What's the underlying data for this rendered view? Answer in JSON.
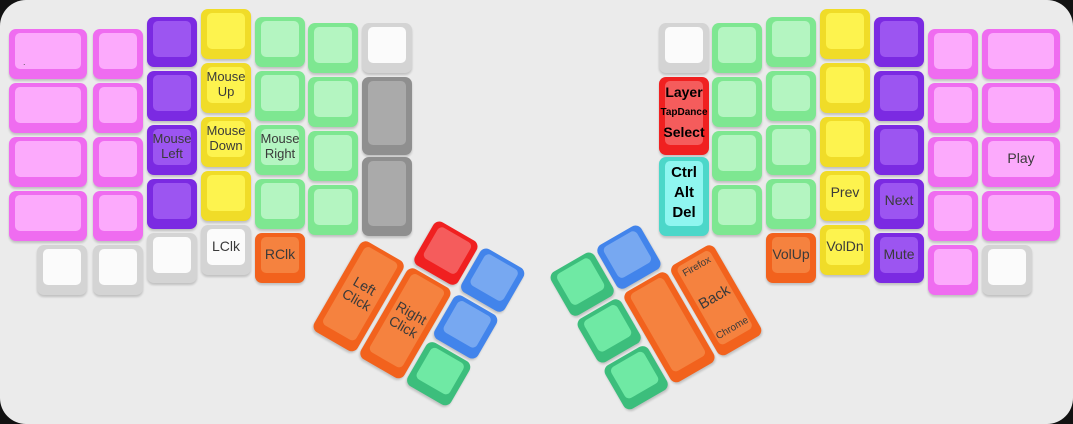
{
  "page": {
    "canvas_background": "#ebebeb",
    "outside_background": "#121212"
  },
  "palette": {
    "pink": {
      "border": "#ef6cf0",
      "face": "#fcaafc"
    },
    "purple": {
      "border": "#7b2ae2",
      "face": "#9c55f1"
    },
    "yellow": {
      "border": "#f0dc28",
      "face": "#fdf34e"
    },
    "palegreen": {
      "border": "#7ee791",
      "face": "#b4f5c1"
    },
    "white": {
      "border": "#d4d4d4",
      "face": "#fbfbfb"
    },
    "gray": {
      "border": "#8f8f8f",
      "face": "#aaaaaa"
    },
    "orange": {
      "border": "#f2621d",
      "face": "#f5823f"
    },
    "red": {
      "border": "#f02020",
      "face": "#f55c5c"
    },
    "cyan": {
      "border": "#4cd7c9",
      "face": "#8ff6f0"
    },
    "blue": {
      "border": "#4284eb",
      "face": "#77a8f1"
    },
    "emerald": {
      "border": "#3cbe7c",
      "face": "#6fe9a4"
    }
  },
  "keyboard": {
    "unit_px": 54,
    "key_px": 50,
    "main_keys": [
      {
        "name": "key-left-col1-row1",
        "color": "pink",
        "x": 9,
        "y": 29,
        "w": 78,
        "h": 50,
        "labels": [
          {
            "t": ".",
            "cls": "dot"
          }
        ]
      },
      {
        "name": "key-left-col1-row2",
        "color": "pink",
        "x": 9,
        "y": 83,
        "w": 78,
        "h": 50,
        "labels": []
      },
      {
        "name": "key-left-col1-row3",
        "color": "pink",
        "x": 9,
        "y": 137,
        "w": 78,
        "h": 50,
        "labels": []
      },
      {
        "name": "key-left-col1-row4",
        "color": "pink",
        "x": 9,
        "y": 191,
        "w": 78,
        "h": 50,
        "labels": []
      },
      {
        "name": "key-left-col1-row5",
        "color": "white",
        "x": 37,
        "y": 245,
        "w": 50,
        "h": 50,
        "labels": []
      },
      {
        "name": "key-left-col2-row1",
        "color": "pink",
        "x": 93,
        "y": 29,
        "w": 50,
        "h": 50,
        "labels": []
      },
      {
        "name": "key-left-col2-row2",
        "color": "pink",
        "x": 93,
        "y": 83,
        "w": 50,
        "h": 50,
        "labels": []
      },
      {
        "name": "key-left-col2-row3",
        "color": "pink",
        "x": 93,
        "y": 137,
        "w": 50,
        "h": 50,
        "labels": []
      },
      {
        "name": "key-left-col2-row4",
        "color": "pink",
        "x": 93,
        "y": 191,
        "w": 50,
        "h": 50,
        "labels": []
      },
      {
        "name": "key-left-col2-row5",
        "color": "white",
        "x": 93,
        "y": 245,
        "w": 50,
        "h": 50,
        "labels": []
      },
      {
        "name": "key-left-col3-row1",
        "color": "purple",
        "x": 147,
        "y": 17,
        "w": 50,
        "h": 50,
        "labels": []
      },
      {
        "name": "key-left-col3-row2",
        "color": "purple",
        "x": 147,
        "y": 71,
        "w": 50,
        "h": 50,
        "labels": []
      },
      {
        "name": "key-mouse-left",
        "color": "purple",
        "x": 147,
        "y": 125,
        "w": 50,
        "h": 50,
        "labels": [
          {
            "t": "Mouse\nLeft",
            "cls": ""
          }
        ]
      },
      {
        "name": "key-left-col3-row4",
        "color": "purple",
        "x": 147,
        "y": 179,
        "w": 50,
        "h": 50,
        "labels": []
      },
      {
        "name": "key-left-col3-row5",
        "color": "white",
        "x": 147,
        "y": 233,
        "w": 50,
        "h": 50,
        "labels": []
      },
      {
        "name": "key-left-col4-row1",
        "color": "yellow",
        "x": 201,
        "y": 9,
        "w": 50,
        "h": 50,
        "labels": []
      },
      {
        "name": "key-mouse-up",
        "color": "yellow",
        "x": 201,
        "y": 63,
        "w": 50,
        "h": 50,
        "labels": [
          {
            "t": "Mouse\nUp",
            "cls": ""
          }
        ]
      },
      {
        "name": "key-mouse-down",
        "color": "yellow",
        "x": 201,
        "y": 117,
        "w": 50,
        "h": 50,
        "labels": [
          {
            "t": "Mouse\nDown",
            "cls": ""
          }
        ]
      },
      {
        "name": "key-left-col4-row4",
        "color": "yellow",
        "x": 201,
        "y": 171,
        "w": 50,
        "h": 50,
        "labels": []
      },
      {
        "name": "key-lclk",
        "color": "white",
        "x": 201,
        "y": 225,
        "w": 50,
        "h": 50,
        "labels": [
          {
            "t": "LClk",
            "cls": "md"
          }
        ]
      },
      {
        "name": "key-left-col5-row1",
        "color": "palegreen",
        "x": 255,
        "y": 17,
        "w": 50,
        "h": 50,
        "labels": []
      },
      {
        "name": "key-left-col5-row2",
        "color": "palegreen",
        "x": 255,
        "y": 71,
        "w": 50,
        "h": 50,
        "labels": []
      },
      {
        "name": "key-mouse-right",
        "color": "palegreen",
        "x": 255,
        "y": 125,
        "w": 50,
        "h": 50,
        "labels": [
          {
            "t": "Mouse\nRight",
            "cls": ""
          }
        ]
      },
      {
        "name": "key-left-col5-row4",
        "color": "palegreen",
        "x": 255,
        "y": 179,
        "w": 50,
        "h": 50,
        "labels": []
      },
      {
        "name": "key-rclk",
        "color": "orange",
        "x": 255,
        "y": 233,
        "w": 50,
        "h": 50,
        "labels": [
          {
            "t": "RClk",
            "cls": "md"
          }
        ]
      },
      {
        "name": "key-left-col6-row1",
        "color": "palegreen",
        "x": 308,
        "y": 23,
        "w": 50,
        "h": 50,
        "labels": []
      },
      {
        "name": "key-left-col6-row2",
        "color": "palegreen",
        "x": 308,
        "y": 77,
        "w": 50,
        "h": 50,
        "labels": []
      },
      {
        "name": "key-left-col6-row3",
        "color": "palegreen",
        "x": 308,
        "y": 131,
        "w": 50,
        "h": 50,
        "labels": []
      },
      {
        "name": "key-left-col6-row4",
        "color": "palegreen",
        "x": 308,
        "y": 185,
        "w": 50,
        "h": 50,
        "labels": []
      },
      {
        "name": "key-left-col7-row1",
        "color": "white",
        "x": 362,
        "y": 23,
        "w": 50,
        "h": 50,
        "labels": []
      },
      {
        "name": "key-left-col7-tall1",
        "color": "gray",
        "x": 362,
        "y": 77,
        "w": 50,
        "h": 78,
        "labels": []
      },
      {
        "name": "key-left-col7-tall2",
        "color": "gray",
        "x": 362,
        "y": 157,
        "w": 50,
        "h": 79,
        "labels": []
      },
      {
        "name": "key-right-col7-row1",
        "color": "white",
        "x": 659,
        "y": 23,
        "w": 50,
        "h": 50,
        "labels": []
      },
      {
        "name": "key-layer-tapdance-select",
        "color": "red",
        "x": 659,
        "y": 77,
        "w": 50,
        "h": 78,
        "labels": [
          {
            "t": "Layer",
            "cls": "bold md"
          },
          {
            "t": "TapDance",
            "cls": "bold xs"
          },
          {
            "t": "Select",
            "cls": "bold md"
          }
        ]
      },
      {
        "name": "key-ctrl-alt-del",
        "color": "cyan",
        "x": 659,
        "y": 157,
        "w": 50,
        "h": 79,
        "labels": [
          {
            "t": "Ctrl",
            "cls": "bold lg"
          },
          {
            "t": "Alt",
            "cls": "bold lg"
          },
          {
            "t": "Del",
            "cls": "bold lg"
          }
        ]
      },
      {
        "name": "key-right-col6-row1",
        "color": "palegreen",
        "x": 712,
        "y": 23,
        "w": 50,
        "h": 50,
        "labels": []
      },
      {
        "name": "key-right-col6-row2",
        "color": "palegreen",
        "x": 712,
        "y": 77,
        "w": 50,
        "h": 50,
        "labels": []
      },
      {
        "name": "key-right-col6-row3",
        "color": "palegreen",
        "x": 712,
        "y": 131,
        "w": 50,
        "h": 50,
        "labels": []
      },
      {
        "name": "key-right-col6-row4",
        "color": "palegreen",
        "x": 712,
        "y": 185,
        "w": 50,
        "h": 50,
        "labels": []
      },
      {
        "name": "key-right-col5-row1",
        "color": "palegreen",
        "x": 766,
        "y": 17,
        "w": 50,
        "h": 50,
        "labels": []
      },
      {
        "name": "key-right-col5-row2",
        "color": "palegreen",
        "x": 766,
        "y": 71,
        "w": 50,
        "h": 50,
        "labels": []
      },
      {
        "name": "key-right-col5-row3",
        "color": "palegreen",
        "x": 766,
        "y": 125,
        "w": 50,
        "h": 50,
        "labels": []
      },
      {
        "name": "key-right-col5-row4",
        "color": "palegreen",
        "x": 766,
        "y": 179,
        "w": 50,
        "h": 50,
        "labels": []
      },
      {
        "name": "key-volup",
        "color": "orange",
        "x": 766,
        "y": 233,
        "w": 50,
        "h": 50,
        "labels": [
          {
            "t": "VolUp",
            "cls": "md"
          }
        ]
      },
      {
        "name": "key-right-col4-row1",
        "color": "yellow",
        "x": 820,
        "y": 9,
        "w": 50,
        "h": 50,
        "labels": []
      },
      {
        "name": "key-right-col4-row2",
        "color": "yellow",
        "x": 820,
        "y": 63,
        "w": 50,
        "h": 50,
        "labels": []
      },
      {
        "name": "key-right-col4-row3",
        "color": "yellow",
        "x": 820,
        "y": 117,
        "w": 50,
        "h": 50,
        "labels": []
      },
      {
        "name": "key-prev",
        "color": "yellow",
        "x": 820,
        "y": 171,
        "w": 50,
        "h": 50,
        "labels": [
          {
            "t": "Prev",
            "cls": "md"
          }
        ]
      },
      {
        "name": "key-voldn",
        "color": "yellow",
        "x": 820,
        "y": 225,
        "w": 50,
        "h": 50,
        "labels": [
          {
            "t": "VolDn",
            "cls": "md"
          }
        ]
      },
      {
        "name": "key-right-col3-row1",
        "color": "purple",
        "x": 874,
        "y": 17,
        "w": 50,
        "h": 50,
        "labels": []
      },
      {
        "name": "key-right-col3-row2",
        "color": "purple",
        "x": 874,
        "y": 71,
        "w": 50,
        "h": 50,
        "labels": []
      },
      {
        "name": "key-right-col3-row3",
        "color": "purple",
        "x": 874,
        "y": 125,
        "w": 50,
        "h": 50,
        "labels": []
      },
      {
        "name": "key-next",
        "color": "purple",
        "x": 874,
        "y": 179,
        "w": 50,
        "h": 50,
        "labels": [
          {
            "t": "Next",
            "cls": "md"
          }
        ]
      },
      {
        "name": "key-mute",
        "color": "purple",
        "x": 874,
        "y": 233,
        "w": 50,
        "h": 50,
        "labels": [
          {
            "t": "Mute",
            "cls": "md"
          }
        ]
      },
      {
        "name": "key-right-col2-row1",
        "color": "pink",
        "x": 928,
        "y": 29,
        "w": 50,
        "h": 50,
        "labels": []
      },
      {
        "name": "key-right-col2-row2",
        "color": "pink",
        "x": 928,
        "y": 83,
        "w": 50,
        "h": 50,
        "labels": []
      },
      {
        "name": "key-right-col2-row3",
        "color": "pink",
        "x": 928,
        "y": 137,
        "w": 50,
        "h": 50,
        "labels": []
      },
      {
        "name": "key-right-col2-row4",
        "color": "pink",
        "x": 928,
        "y": 191,
        "w": 50,
        "h": 50,
        "labels": []
      },
      {
        "name": "key-right-col2-row5",
        "color": "pink",
        "x": 928,
        "y": 245,
        "w": 50,
        "h": 50,
        "labels": []
      },
      {
        "name": "key-right-col1-row1",
        "color": "pink",
        "x": 982,
        "y": 29,
        "w": 78,
        "h": 50,
        "labels": []
      },
      {
        "name": "key-right-col1-row2",
        "color": "pink",
        "x": 982,
        "y": 83,
        "w": 78,
        "h": 50,
        "labels": []
      },
      {
        "name": "key-play",
        "color": "pink",
        "x": 982,
        "y": 137,
        "w": 78,
        "h": 50,
        "labels": [
          {
            "t": "Play",
            "cls": "md"
          }
        ]
      },
      {
        "name": "key-right-col1-row4",
        "color": "pink",
        "x": 982,
        "y": 191,
        "w": 78,
        "h": 50,
        "labels": []
      },
      {
        "name": "key-right-col1-row5",
        "color": "white",
        "x": 982,
        "y": 245,
        "w": 50,
        "h": 50,
        "labels": []
      }
    ],
    "thumb_clusters": [
      {
        "name": "left-thumb-cluster",
        "origin_x": 390,
        "origin_y": 192,
        "rotation_deg": 30,
        "keys": [
          {
            "name": "key-left-thumb-red",
            "color": "red",
            "x": 54,
            "y": 0,
            "w": 50,
            "h": 50,
            "labels": []
          },
          {
            "name": "key-left-thumb-blue-top",
            "color": "blue",
            "x": 108,
            "y": 0,
            "w": 50,
            "h": 50,
            "labels": []
          },
          {
            "name": "key-left-click",
            "color": "orange",
            "x": 0,
            "y": 54,
            "w": 50,
            "h": 104,
            "labels": [
              {
                "t": "Left\nClick",
                "cls": "md"
              }
            ]
          },
          {
            "name": "key-right-click",
            "color": "orange",
            "x": 54,
            "y": 54,
            "w": 50,
            "h": 104,
            "labels": [
              {
                "t": "Right\nClick",
                "cls": "md"
              }
            ]
          },
          {
            "name": "key-left-thumb-blue-mid",
            "color": "blue",
            "x": 108,
            "y": 54,
            "w": 50,
            "h": 50,
            "labels": []
          },
          {
            "name": "key-left-thumb-green",
            "color": "emerald",
            "x": 108,
            "y": 108,
            "w": 50,
            "h": 50,
            "labels": []
          }
        ]
      },
      {
        "name": "right-thumb-cluster",
        "origin_x": 548,
        "origin_y": 275,
        "rotation_deg": -30,
        "keys": [
          {
            "name": "key-right-thumb-green-top",
            "color": "emerald",
            "x": 0,
            "y": 0,
            "w": 50,
            "h": 50,
            "labels": []
          },
          {
            "name": "key-right-thumb-blue",
            "color": "blue",
            "x": 54,
            "y": 0,
            "w": 50,
            "h": 50,
            "labels": []
          },
          {
            "name": "key-right-thumb-green-mid",
            "color": "emerald",
            "x": 0,
            "y": 54,
            "w": 50,
            "h": 50,
            "labels": []
          },
          {
            "name": "key-right-thumb-green-bot",
            "color": "emerald",
            "x": 0,
            "y": 108,
            "w": 50,
            "h": 50,
            "labels": []
          },
          {
            "name": "key-right-thumb-blank",
            "color": "orange",
            "x": 54,
            "y": 54,
            "w": 50,
            "h": 104,
            "labels": []
          },
          {
            "name": "key-back-firefox-chrome",
            "color": "orange",
            "x": 108,
            "y": 54,
            "w": 50,
            "h": 104,
            "labels": [
              {
                "t": "Firefox",
                "cls": "xs"
              },
              {
                "t": "Back",
                "cls": "lg"
              },
              {
                "t": "Chrome",
                "cls": "xs"
              }
            ]
          }
        ]
      }
    ]
  }
}
